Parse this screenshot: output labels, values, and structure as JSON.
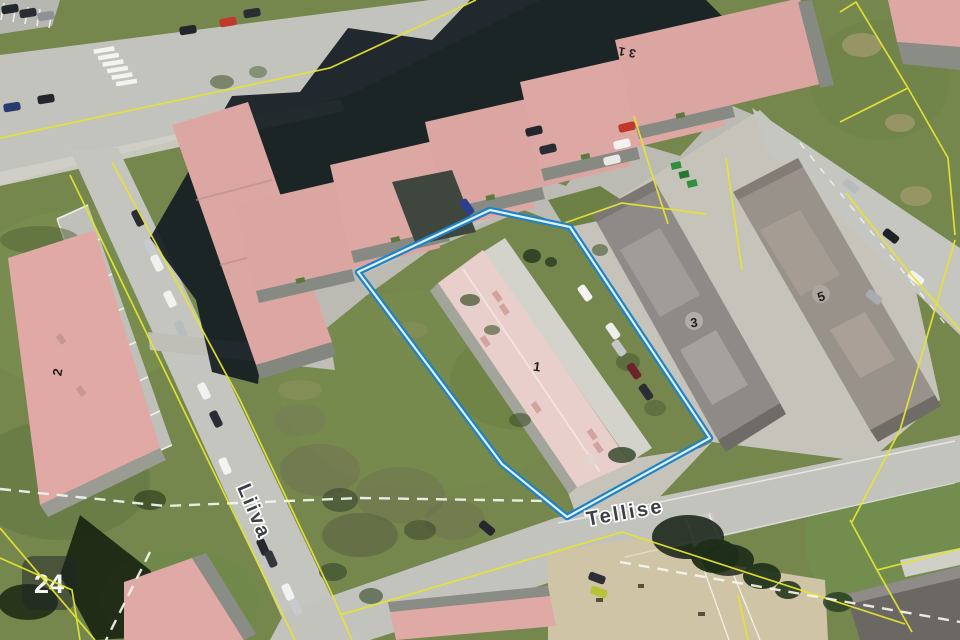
{
  "map": {
    "streets": {
      "tellise": "Tellise",
      "liiva": "Liiva"
    },
    "buildings": {
      "b31": "31",
      "b1": "1",
      "b2": "2",
      "b3": "3",
      "b5": "5"
    },
    "watermark": {
      "label": "24"
    },
    "colors": {
      "selection_outer": "#1e82c4",
      "selection_inner": "#dff0fb",
      "cadastral": "#e4e433",
      "grass": "#75874d",
      "road": "#c3c3bd",
      "roof_pink": "#dba6a2",
      "roof_pale": "#e9cfcb",
      "roof_gray": "#8e8a87"
    }
  }
}
